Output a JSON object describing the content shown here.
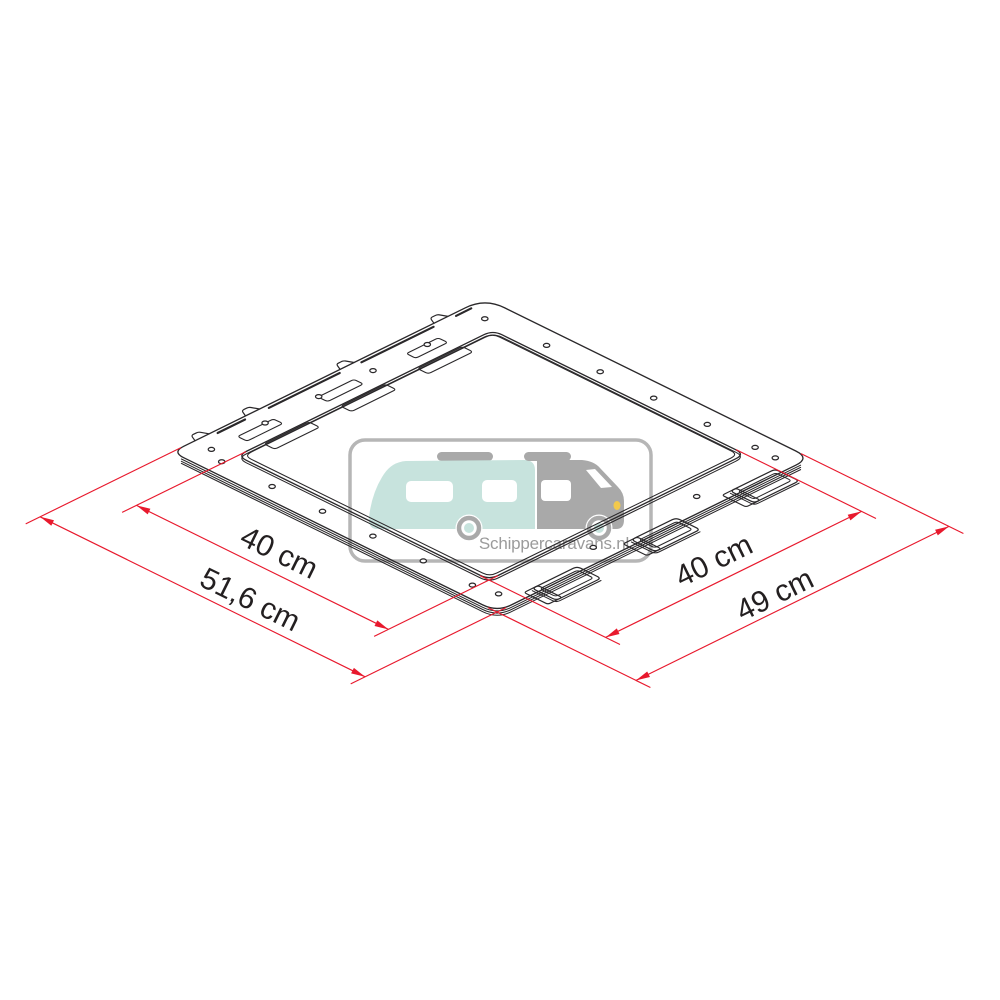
{
  "diagram": {
    "type": "isometric-technical-drawing",
    "subject": "roof-vent-fixing-frame",
    "line_color": "#2a282a",
    "dimension_color": "#e8192d",
    "label_color": "#231f20",
    "dimensions": {
      "left_inner": "40 cm",
      "left_outer": "51,6 cm",
      "right_inner": "40 cm",
      "right_outer": "49 cm"
    }
  },
  "watermark": {
    "text": "Schippercaravans.nl",
    "text_color": "#9b9b9b",
    "border_color": "#b6b6b6",
    "caravan_color": "#c7e3dd",
    "vehicle_gray": "#a9a9a9",
    "window_color": "#ffffff",
    "headlight_color": "#f2c94c"
  }
}
